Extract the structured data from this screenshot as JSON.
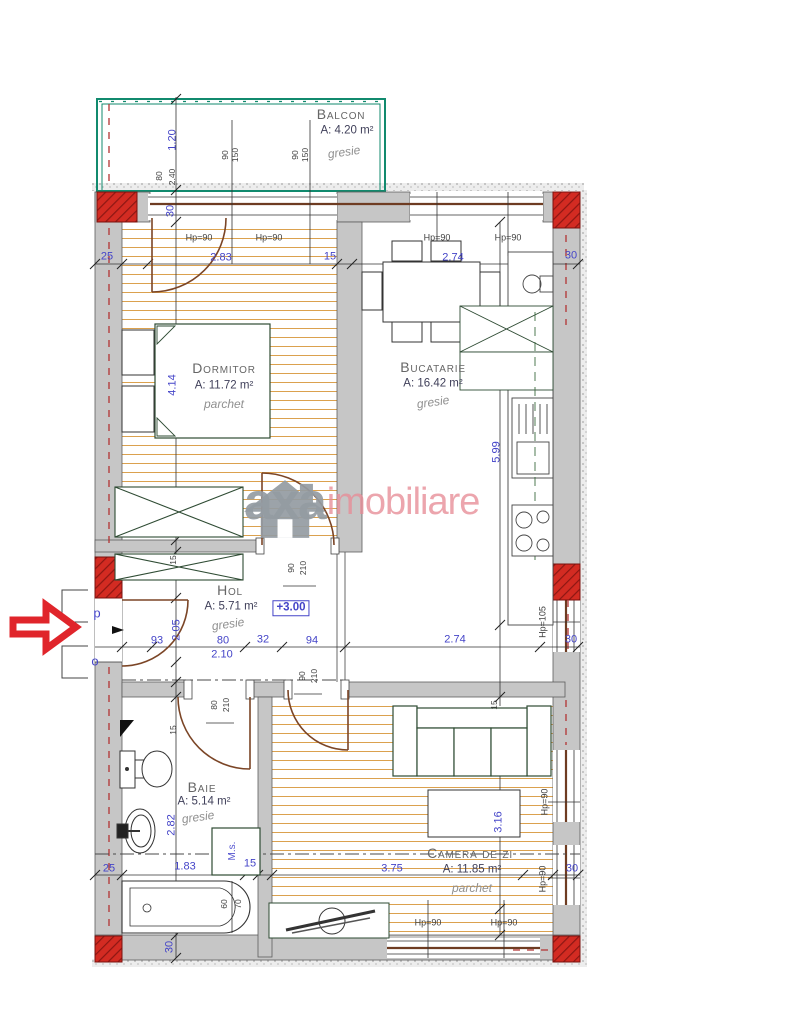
{
  "watermark": {
    "brand_gray": "axa",
    "brand_pink": "imobiliare"
  },
  "annotations": {
    "level": "+3.00",
    "entry_p": "p",
    "entry_o": "o",
    "ms": "M.s."
  },
  "rooms": {
    "balcon": {
      "name": "Balcon",
      "area": "A: 4.20 m²",
      "finish": "gresie"
    },
    "dormitor": {
      "name": "Dormitor",
      "area": "A: 11.72 m²",
      "finish": "parchet"
    },
    "bucatarie": {
      "name": "Bucatarie",
      "area": "A: 16.42 m²",
      "finish": "gresie"
    },
    "hol": {
      "name": "Hol",
      "area": "A: 5.71 m²",
      "finish": "gresie"
    },
    "baie": {
      "name": "Baie",
      "area": "A: 5.14 m²",
      "finish": "gresie"
    },
    "camera": {
      "name": "Camera de zi",
      "area": "A: 11.85 m²",
      "finish": "parchet"
    }
  },
  "window_labels": {
    "hp90": "Hp=90",
    "hp105": "Hp=105",
    "w90": "90",
    "h150": "150"
  },
  "door_labels": {
    "w90": "90",
    "w80": "80",
    "h210": "210"
  },
  "dims": {
    "d25": "25",
    "d283": "2.83",
    "d15": "15",
    "d274": "2.74",
    "d30": "30",
    "d120": "1.20",
    "d80w": "80",
    "d240": "2.40",
    "d414": "4.14",
    "d205": "2.05",
    "d282": "2.82",
    "d93": "93",
    "d80": "80",
    "d32": "32",
    "d94": "94",
    "d210m": "2.10",
    "d599": "5.99",
    "d316": "3.16",
    "d375": "3.75",
    "d183": "1.83",
    "d60": "60",
    "d70": "70"
  }
}
